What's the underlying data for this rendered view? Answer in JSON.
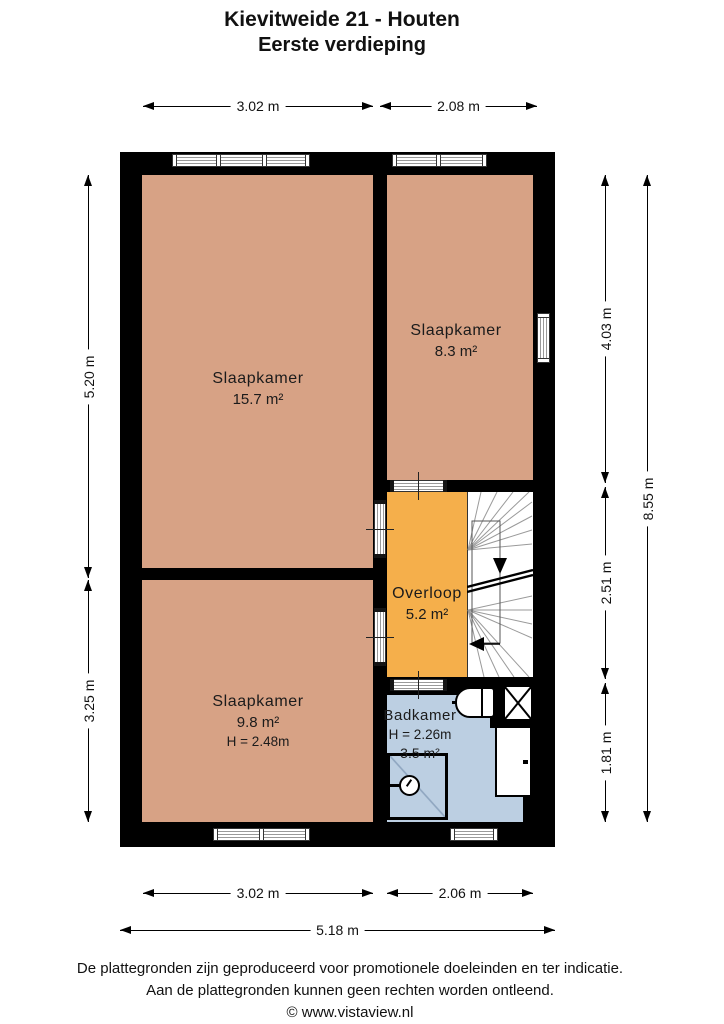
{
  "title": {
    "line1": "Kievitweide 21 - Houten",
    "line2": "Eerste verdieping"
  },
  "rooms": {
    "slaapkamer_large": {
      "name": "Slaapkamer",
      "area": "15.7 m²"
    },
    "slaapkamer_right": {
      "name": "Slaapkamer",
      "area": "8.3 m²"
    },
    "slaapkamer_small": {
      "name": "Slaapkamer",
      "area": "9.8 m²",
      "height": "H = 2.48m"
    },
    "overloop": {
      "name": "Overloop",
      "area": "5.2 m²"
    },
    "badkamer": {
      "name": "Badkamer",
      "height": "H = 2.26m",
      "area": "3.5 m²"
    }
  },
  "dimensions": {
    "top": {
      "left": "3.02 m",
      "right": "2.08 m"
    },
    "left": {
      "upper": "5.20 m",
      "lower": "3.25 m"
    },
    "right": {
      "upper": "4.03 m",
      "middle": "2.51 m",
      "lower": "1.81 m",
      "total": "8.55 m"
    },
    "bottom": {
      "left": "3.02 m",
      "right": "2.06 m",
      "total": "5.18 m"
    }
  },
  "footer": {
    "line1": "De plattegronden zijn geproduceerd voor promotionele doeleinden en ter indicatie.",
    "line2": "Aan de plattegronden kunnen geen rechten worden ontleend.",
    "line3": "© www.vistaview.nl"
  },
  "colors": {
    "wall": "#000000",
    "room_floor": "#D7A285",
    "landing_floor": "#F5AF4B",
    "bathroom_floor": "#BCCFE2",
    "shower_floor": "#A9BFD8",
    "stair_lines": "#9a9a9a"
  }
}
